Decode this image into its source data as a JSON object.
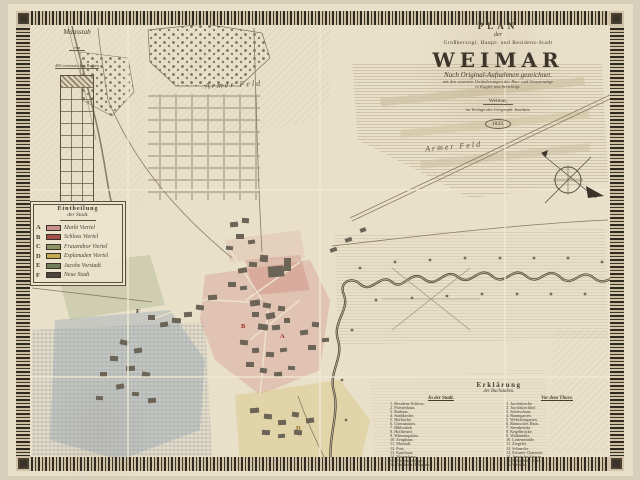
{
  "title_block": {
    "plan": "PLAN",
    "der": "der",
    "dedication": "Großherzogl. Haupt- und Residenz-Stadt",
    "city": "WEIMAR",
    "line1": "Nach Original-Aufnahmen gezeichnet.",
    "line2": "mit den neuesten Veränderungen der Bau- und Strassenzüge",
    "line3": "in Kupfer neu berichtigt.",
    "publisher_city": "Weimar,",
    "publisher": "im Verlage des Geograph. Instituts.",
    "year": "1833."
  },
  "scale_bar": {
    "title": "Maasstab",
    "von": "von",
    "unit": "400 weimarischen Ruthen"
  },
  "quarters_legend": {
    "title_line1": "Eintheilung",
    "title_line2": "der Stadt.",
    "items": [
      {
        "letter": "A",
        "color": "#c98f8a",
        "label": "Markt Viertel"
      },
      {
        "letter": "B",
        "color": "#a34f4a",
        "label": "Schloss Viertel"
      },
      {
        "letter": "C",
        "color": "#8f9464",
        "label": "Frauenthor Viertel"
      },
      {
        "letter": "D",
        "color": "#c4a84f",
        "label": "Esplanaden Viertel"
      },
      {
        "letter": "E",
        "color": "#6f7f5a",
        "label": "Jacobs Vorstadt"
      },
      {
        "letter": "F",
        "color": "#4a463e",
        "label": "Neue Stadt"
      }
    ]
  },
  "letters_legend": {
    "title_line1": "Erklärung",
    "title_line2": "der Buchstaben.",
    "columns": [
      {
        "header": "In der Stadt.",
        "entries": [
          "1. Residenz-Schloss.",
          "2. Fürstenhaus.",
          "3. Rathaus.",
          "4. Stadtkirche.",
          "5. Hofkirche.",
          "6. Gymnasium.",
          "7. Bibliothek.",
          "8. Hoftheater.",
          "9. Wittumspalais.",
          "10. Zeughaus.",
          "11. Marstall.",
          "12. Post.",
          "13. Kaufhaus.",
          "14. Waisenhaus.",
          "15. Freimaurerloge.",
          "16. Gasthof z. Erbprinz."
        ]
      },
      {
        "header": "Vor dem Thore.",
        "entries": [
          "1. Jacobskirche.",
          "2. Jacobskirchhof.",
          "3. Schiesshaus.",
          "4. Baumgarten.",
          "5. Welschengarten.",
          "6. Römisches Haus.",
          "7. Sternbrücke.",
          "8. Kegelbrücke.",
          "9. Walkmühle.",
          "10. Lottenmühle.",
          "11. Ziegelei.",
          "12. Schnecke.",
          "13. Erfurter Chaussee.",
          "14. Jenaische Strasse.",
          "15. Belvederer Allee.",
          "16. Webicht."
        ]
      }
    ]
  },
  "map_labels": {
    "field_nw": "Armer Feld",
    "field_ne": "Armer Feld",
    "letter_a": "A",
    "letter_b": "B",
    "letter_d": "D",
    "letter_f": "F"
  },
  "colors": {
    "quarter_pink": "#d79f96",
    "quarter_blue": "#93a5b5",
    "quarter_yellow": "#d9c888",
    "quarter_green": "#a8b489",
    "river": "#55503f",
    "border_dark": "#2f2a22"
  }
}
